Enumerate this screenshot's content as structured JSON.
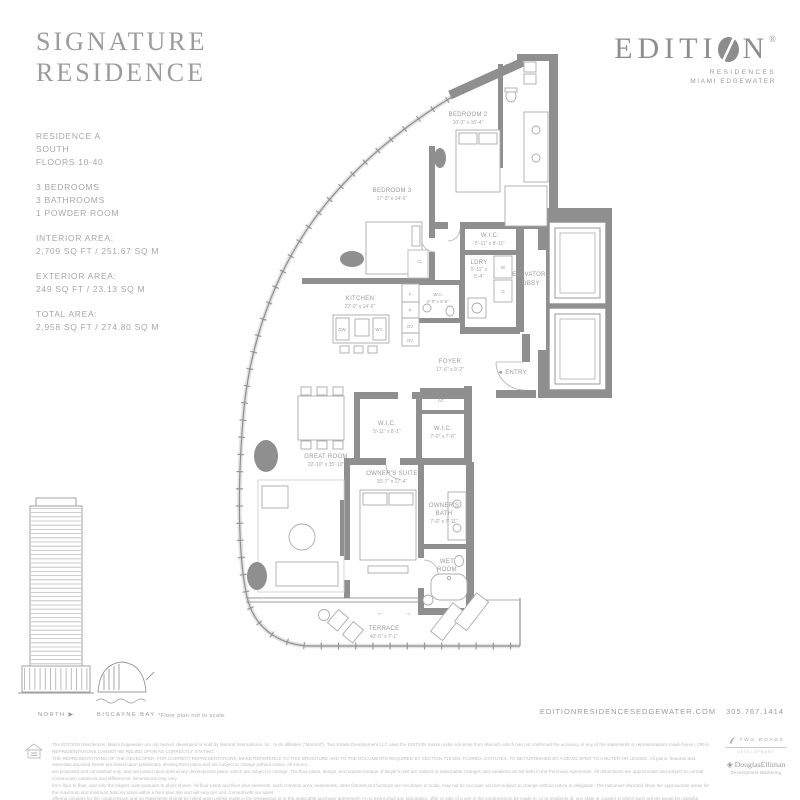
{
  "header": {
    "title_line1": "SIGNATURE",
    "title_line2": "RESIDENCE",
    "brand_pre": "EDITI",
    "brand_post": "N",
    "brand_reg": "®",
    "brand_sub1": "RESIDENCES",
    "brand_sub2": "MIAMI EDGEWATER"
  },
  "specs": {
    "residence": "RESIDENCE A",
    "orientation": "SOUTH",
    "floors": "FLOORS 10-40",
    "bedrooms": "3 BEDROOMS",
    "bathrooms": "3 BATHROOMS",
    "powder": "1 POWDER ROOM",
    "interior_label": "INTERIOR AREA:",
    "interior_value": "2,709 SQ FT / 251.67 SQ M",
    "exterior_label": "EXTERIOR AREA:",
    "exterior_value": "249 SQ FT / 23.13 SQ M",
    "total_label": "TOTAL AREA:",
    "total_value": "2,958 SQ FT / 274.80 SQ M"
  },
  "plan": {
    "arrow_left": "←",
    "arrow_right": "→",
    "rooms": {
      "bedroom2": {
        "name": "BEDROOM 2",
        "dims": "10'-2\" x 16'-4\""
      },
      "bedroom3": {
        "name": "BEDROOM 3",
        "dims": "17'-3\" x 14'-6\""
      },
      "wic1": {
        "name": "W.I.C.",
        "dims": "5'-11\" x 8'-11\""
      },
      "ldry": {
        "name": "LDRY",
        "dims1": "5'-11\" x",
        "dims2": "5'-4\""
      },
      "elevator_lobby": {
        "line1": "ELEVATOR",
        "line2": "LOBBY"
      },
      "kitchen": {
        "name": "KITCHEN",
        "dims": "22'-0\" x 14'-6\""
      },
      "powder": {
        "name": "W.C.",
        "dims": "6'-0\" x 6'-5\""
      },
      "foyer": {
        "name": "FOYER",
        "dims": "17'-6\" x 9'-2\""
      },
      "entry": "◄ ENTRY",
      "great_room": {
        "name": "GREAT ROOM",
        "dims": "22'-10\" x 35'-10\""
      },
      "wic2": {
        "name": "W.I.C.",
        "dims": "5'-11\" x 8'-1\""
      },
      "wic3": {
        "name": "W.I.C.",
        "dims": "7'-0\" x 7'-8\""
      },
      "ac": "AC",
      "cl": "CL",
      "owners_suite": {
        "name": "OWNER'S SUITE",
        "dims": "15'-7\" x 17'-4\""
      },
      "owners_bath": {
        "line1": "OWNER'S",
        "line2": "BATH",
        "dims": "7'-0\" x 7'-11\""
      },
      "wet_room": {
        "line1": "WET",
        "line2": "ROOM"
      },
      "terrace": {
        "name": "TERRACE",
        "dims": "43'-6\" x 7'-1\""
      }
    },
    "appliances": {
      "washer": "W",
      "dryer": "D",
      "dishwasher": "DW",
      "wine_cooler": "WC",
      "fridge": "F",
      "pantry": "P",
      "oven_upper": "OV",
      "oven_lower": "OV"
    }
  },
  "footer_left": {
    "north": "NORTH ▶",
    "bay": "BISCAYNE BAY",
    "not_to_scale": "*Floor plan not to scale."
  },
  "footer_right": {
    "website": "EDITIONRESIDENCESEDGEWATER.COM",
    "phone": "305.767.1414"
  },
  "logos": {
    "two_roads": "TWO ROADS",
    "two_roads_sub": "DEVELOPMENT",
    "elliman": "◈ DouglasElliman",
    "elliman_sub": "Development Marketing"
  },
  "disclaimer": {
    "line1": "The EDITION Residences, Miami Edgewater are not owned, developed or sold by Marriott International, Inc. or its affiliates (\"Marriott\"). Two Roads Development LLC uses the EDITION marks under a license from Marriott, which has not confirmed the accuracy of any of the statements or representations made herein. ORAL REPRESENTATIONS CANNOT BE RELIED UPON AS CORRECTLY STATING",
    "line2": "THE REPRESENTATIONS OF THE DEVELOPER. FOR CORRECT REPRESENTATIONS, MAKE REFERENCE TO THIS BROCHURE AND TO THE DOCUMENTS REQUIRED BY SECTION 718.503, FLORIDA STATUTES, TO BE FURNISHED BY A DEVELOPER TO A BUYER OR LESSEE. All plans, features and amenities depicted herein are based upon preliminary development plans and are subject to change without notice. All interior",
    "line3": "are proposed and conceptual only, and are based upon preliminary development plans, which are subject to change. The floor plans, design, and square footage of Buyer's Unit are subject to reasonable changes and variations as set forth in the Purchase Agreement. All dimensions are approximate and subject to normal construction variances and differences. Dimensions may vary",
    "line4": "from floor to floor, and only the largest units pursuant to plans shown. All floor plans and floor plan elements, each common area, easements, other fixtures and furniture are not drawn to scale, may not be accurate and are subject to change without notice or obligation. The balconies depicted show the approximate areas for the maximum and minimum balcony sizes within a floor plan line and will vary per unit. Consult with our sales",
    "line5": "offering circulars for the condominium and no statements should be relied upon unless made in the prospectus or in the applicable purchase agreement. In no event shall any solicitation, offer or sale of a unit in the condominium be made in, or to residents of, any state or country in which such activity would be unlawful. Exclusive Sales & Marketing by Douglas Elliman Development Marketing."
  },
  "colors": {
    "wall": "#8f8f8f",
    "line": "#9a9a9a",
    "text_gray": "#9a9a9a",
    "glass": "#e3e3e3"
  }
}
